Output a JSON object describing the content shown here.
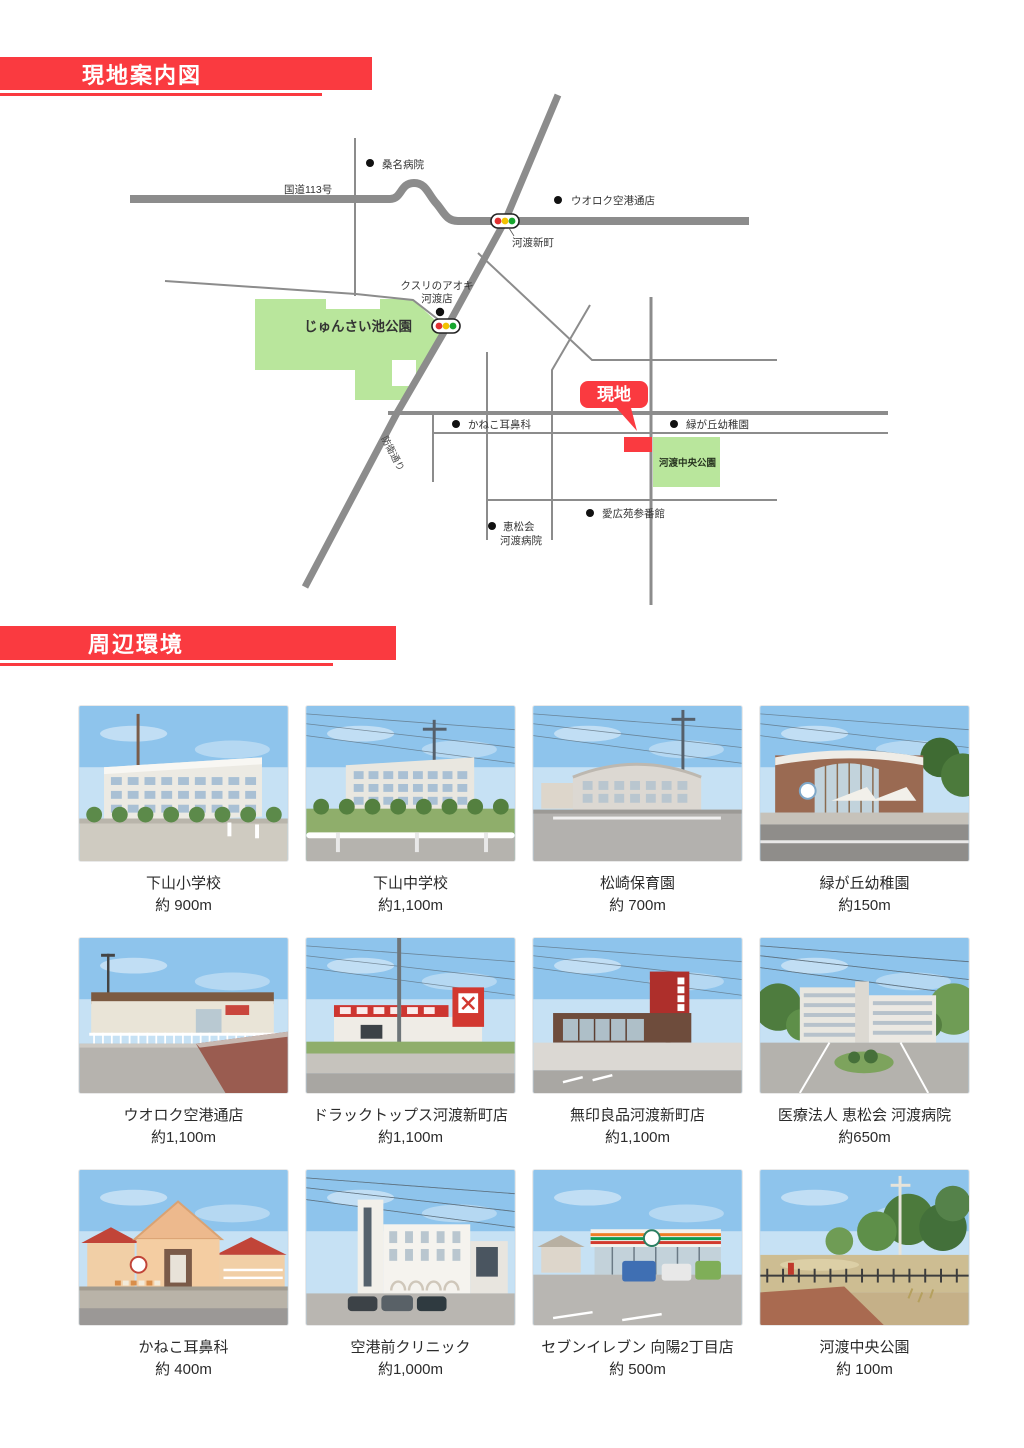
{
  "colors": {
    "accent_red": "#fa3a40",
    "park_green": "#b9e69c",
    "road_gray": "#8c8c8c"
  },
  "sections": [
    {
      "title": "現地案内図"
    },
    {
      "title": "周辺環境"
    }
  ],
  "map": {
    "site_badge": "現地",
    "route_label": "国道113号",
    "street_label": "防衛通り",
    "pois": {
      "kuwana": "桑名病院",
      "uoroku": "ウオロク空港通店",
      "kowato_shinmachi": "河渡新町",
      "kusuri1": "クスリのアオキ",
      "kusuri2": "河渡店",
      "junsai_park": "じゅんさい池公園",
      "kaneko": "かねこ耳鼻科",
      "midorigaoka": "緑が丘幼稚園",
      "kowato_chuo_park": "河渡中央公園",
      "aikoen": "愛広苑参番館",
      "keishokai1": "恵松会",
      "keishokai2": "河渡病院"
    }
  },
  "surroundings": {
    "items": [
      {
        "name": "下山小学校",
        "distance": "約 900m",
        "scene": "school"
      },
      {
        "name": "下山中学校",
        "distance": "約1,100m",
        "scene": "school2"
      },
      {
        "name": "松崎保育園",
        "distance": "約 700m",
        "scene": "nursery"
      },
      {
        "name": "緑が丘幼稚園",
        "distance": "約150m",
        "scene": "kindergarten"
      },
      {
        "name": "ウオロク空港通店",
        "distance": "約1,100m",
        "scene": "supermarket"
      },
      {
        "name": "ドラックトップス河渡新町店",
        "distance": "約1,100m",
        "scene": "drugstore"
      },
      {
        "name": "無印良品河渡新町店",
        "distance": "約1,100m",
        "scene": "muji"
      },
      {
        "name": "医療法人 恵松会 河渡病院",
        "distance": "約650m",
        "scene": "hospital"
      },
      {
        "name": "かねこ耳鼻科",
        "distance": "約 400m",
        "scene": "ent"
      },
      {
        "name": "空港前クリニック",
        "distance": "約1,000m",
        "scene": "clinic"
      },
      {
        "name": "セブンイレブン 向陽2丁目店",
        "distance": "約 500m",
        "scene": "conveni"
      },
      {
        "name": "河渡中央公園",
        "distance": "約 100m",
        "scene": "park"
      }
    ]
  }
}
